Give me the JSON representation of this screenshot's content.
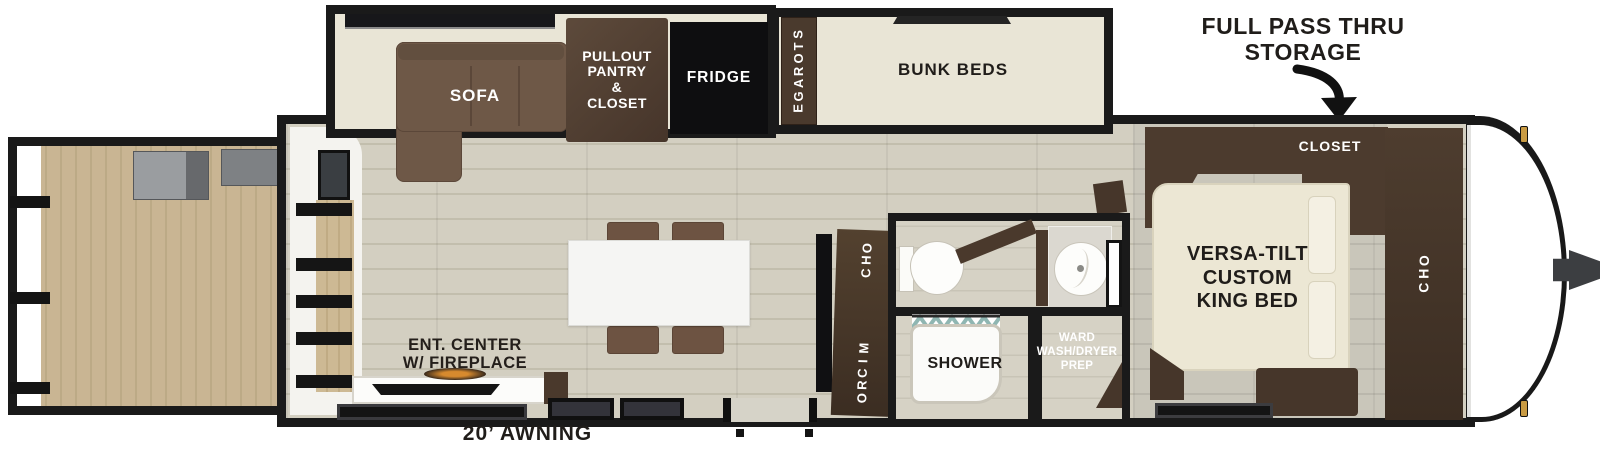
{
  "annotations": {
    "pass_thru": "FULL PASS THRU\nSTORAGE",
    "awning": "20’ AWNING"
  },
  "rooms": {
    "sofa": "SOFA",
    "pantry": "PULLOUT\nPANTRY\n&\nCLOSET",
    "fridge": "FRIDGE",
    "storage": "STORAGE",
    "bunk_beds": "BUNK BEDS",
    "closet": "CLOSET",
    "king_bed": "VERSA-TILT\nCUSTOM\nKING BED",
    "ohc_front": "OHC",
    "ohc_kitchen": "OHC",
    "micro": "MICRO",
    "shower": "SHOWER",
    "wardrobe": "WARD\nWASH/DRYER\nPREP",
    "ent_center": "ENT. CENTER\nW/ FIREPLACE"
  },
  "colors": {
    "wall": "#1a1a1a",
    "main_floor": "#d3cfc1",
    "slide_floor": "#e9e5d6",
    "deck_wood": "#c9b593",
    "dark_wood": "#48372b",
    "sofa_brown": "#6e5847",
    "fridge_black": "#0e0e10",
    "bed_cream": "#ece7d4",
    "label_dark": "#201d1a",
    "label_light": "#ffffff",
    "shower_glass": "#8fb6b2",
    "gold_accent": "#c99b43"
  }
}
